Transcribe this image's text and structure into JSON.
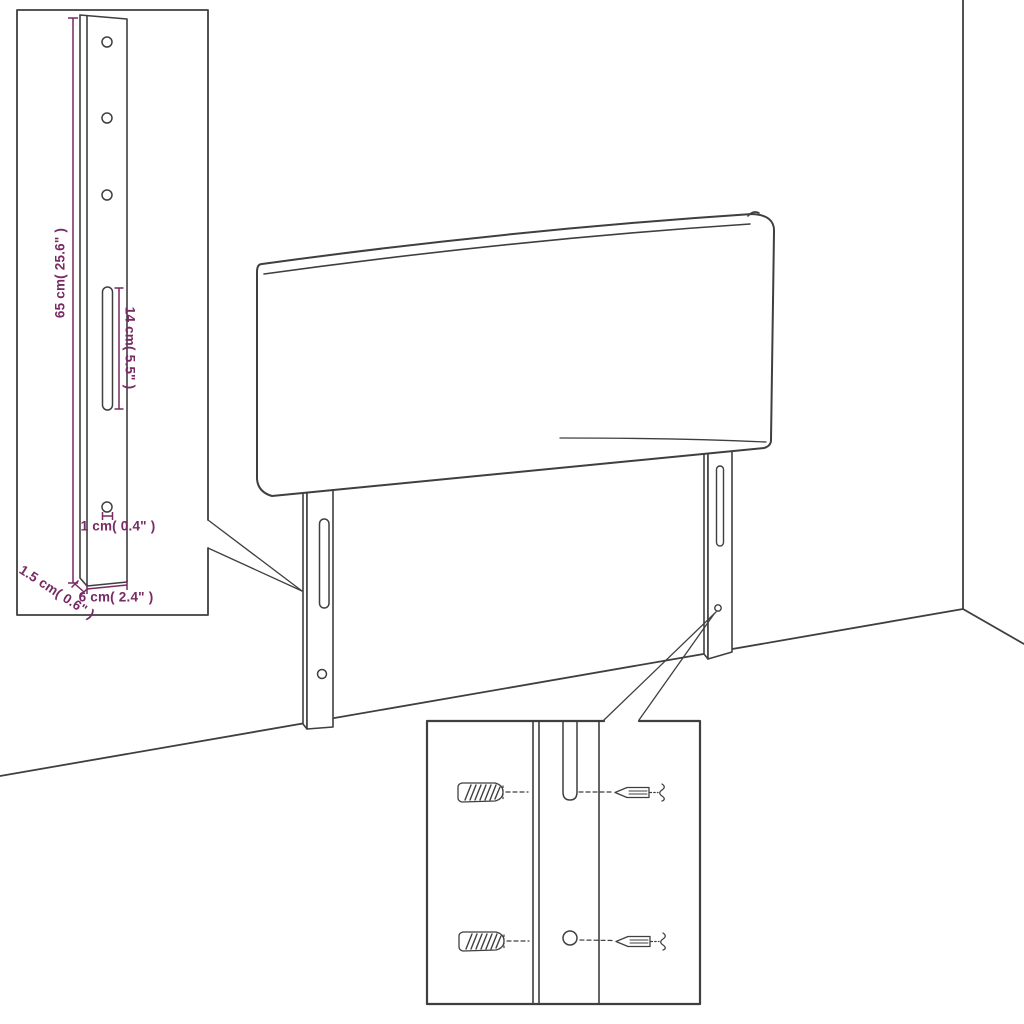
{
  "page": {
    "background": "#ffffff",
    "line_color": "#3f3f3f",
    "dimension_color": "#772a63"
  },
  "leg_detail": {
    "height_label": "65 cm( 25.6\" )",
    "slot_label": "14 cm( 5.5\" )",
    "hole_label": "1 cm( 0.4\" )",
    "depth_label": "1.5 cm( 0.6\" )",
    "width_label": "6 cm( 2.4\" )"
  },
  "fastener_detail": {
    "items": [
      "wall-plug",
      "screw"
    ]
  }
}
